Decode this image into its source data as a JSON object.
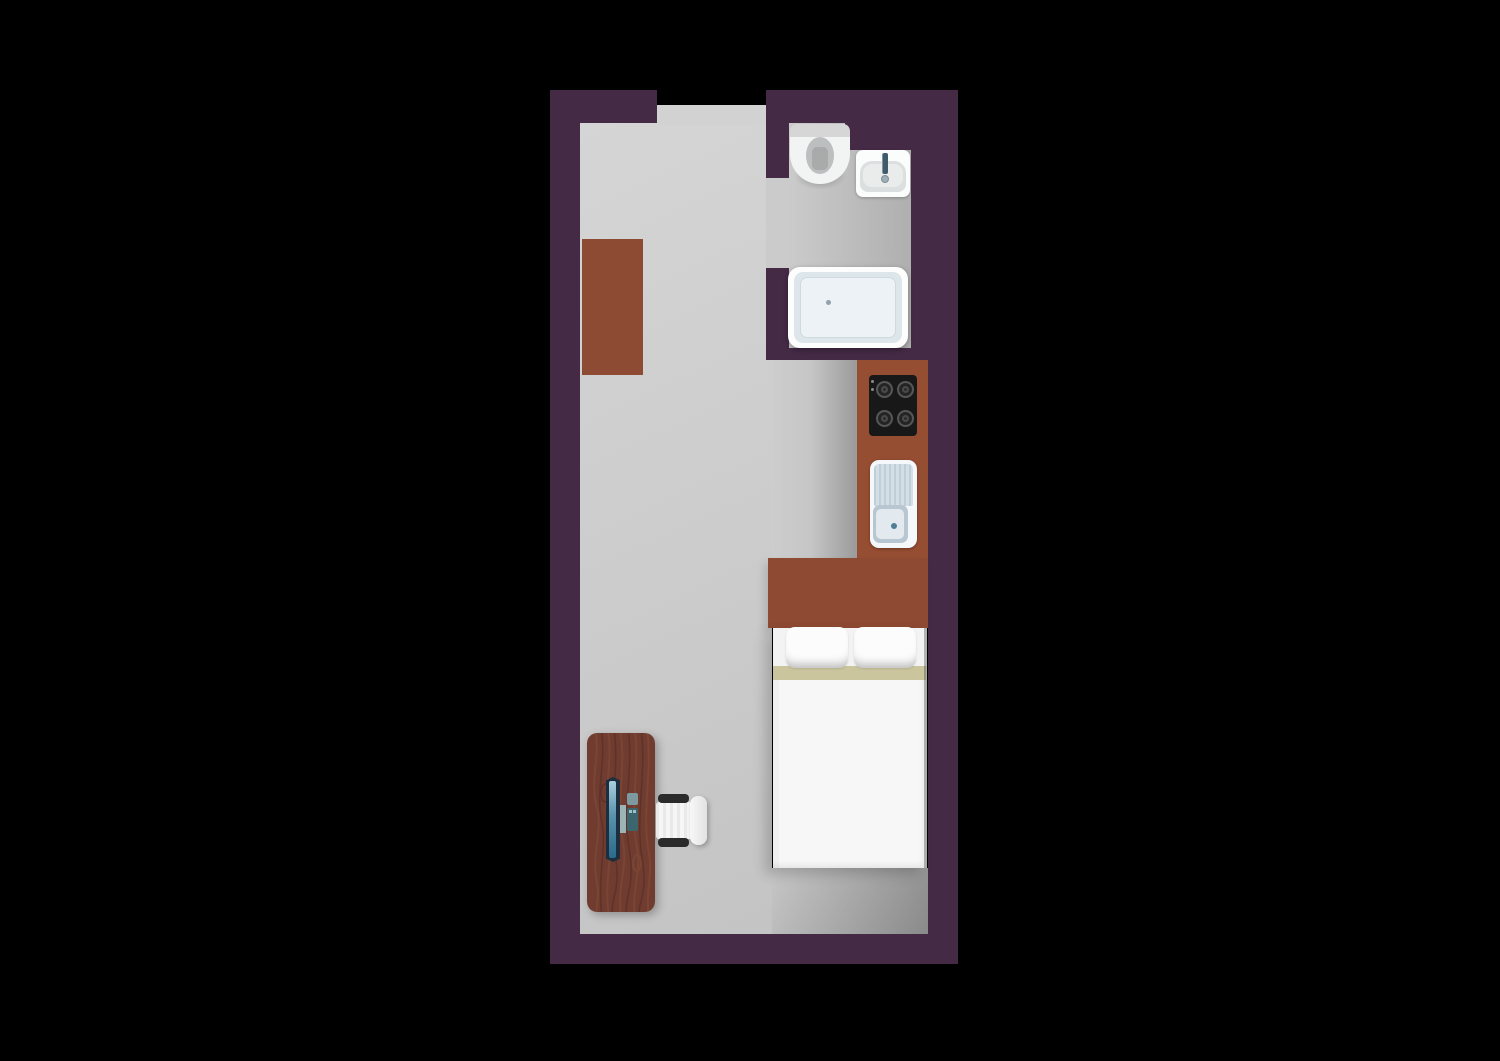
{
  "scene": {
    "title": "studio-apartment-floor-plan-top-view",
    "rooms": [
      {
        "name": "bathroom",
        "fixtures": [
          "toilet",
          "washbasin",
          "bathtub"
        ]
      },
      {
        "name": "kitchen",
        "fixtures": [
          "cooktop-4-burners",
          "kitchen-sink-with-drainboard",
          "counter"
        ]
      },
      {
        "name": "living-sleeping-area",
        "fixtures": [
          "wardrobe",
          "double-bed-two-pillows",
          "desk",
          "monitor",
          "keyboard",
          "mouse",
          "office-chair"
        ]
      }
    ],
    "doorways": [
      "entry-top",
      "bathroom-door"
    ]
  },
  "colors": {
    "background": "#000000",
    "wall": "#452a46",
    "floor_light": "#d5d5d5",
    "floor_mid": "#c4c4c4",
    "floor_dark": "#9b9b9b",
    "floor_bath_dark": "#afafaf",
    "floor_shadow": "#8a8a8a",
    "doorway": "#d2d2d2",
    "closet": "#8d4b33",
    "counter": "#964e32",
    "headboard": "#8e4a32",
    "wood": "#6f3c2f",
    "wood_grain_light": "#7d4636",
    "wood_grain_dark": "#5c3028",
    "blanket": "#cac59d",
    "mattress": "#f7f7f7",
    "pillow": "#fcfcfc",
    "cooktop": "#181818",
    "burner": "#2c2c2c",
    "burner_ring": "#565656",
    "sink_steel": "#d4dfe5",
    "sink_stripe": "#bfcfd8",
    "basin_blue": "#b7c6d1",
    "basin_inner": "#e2eaef",
    "drain": "#517e95",
    "tub_rim": "#fdfdfd",
    "tub_mid": "#dde6ea",
    "tub_floor": "#ecf2f5",
    "toilet_tank": "#d6d6d6",
    "toilet_body": "#f2f4f4",
    "toilet_bowl": "#bcbfbf",
    "toilet_seat": "#a9abab",
    "bsink_body": "#fbfcfc",
    "bsink_basin": "#dcdfe0",
    "faucet": "#3e5b6b",
    "chair_black": "#2b2b2b",
    "chair_seat": "#f6f6f6",
    "monitor_frame": "#1d2e3e",
    "monitor_screen_top": "#a9d0de",
    "monitor_screen_bottom": "#2b6b8b",
    "stand": "#9cb4b3",
    "acc_light": "#7d9aa0",
    "acc_dark": "#3c666e"
  }
}
